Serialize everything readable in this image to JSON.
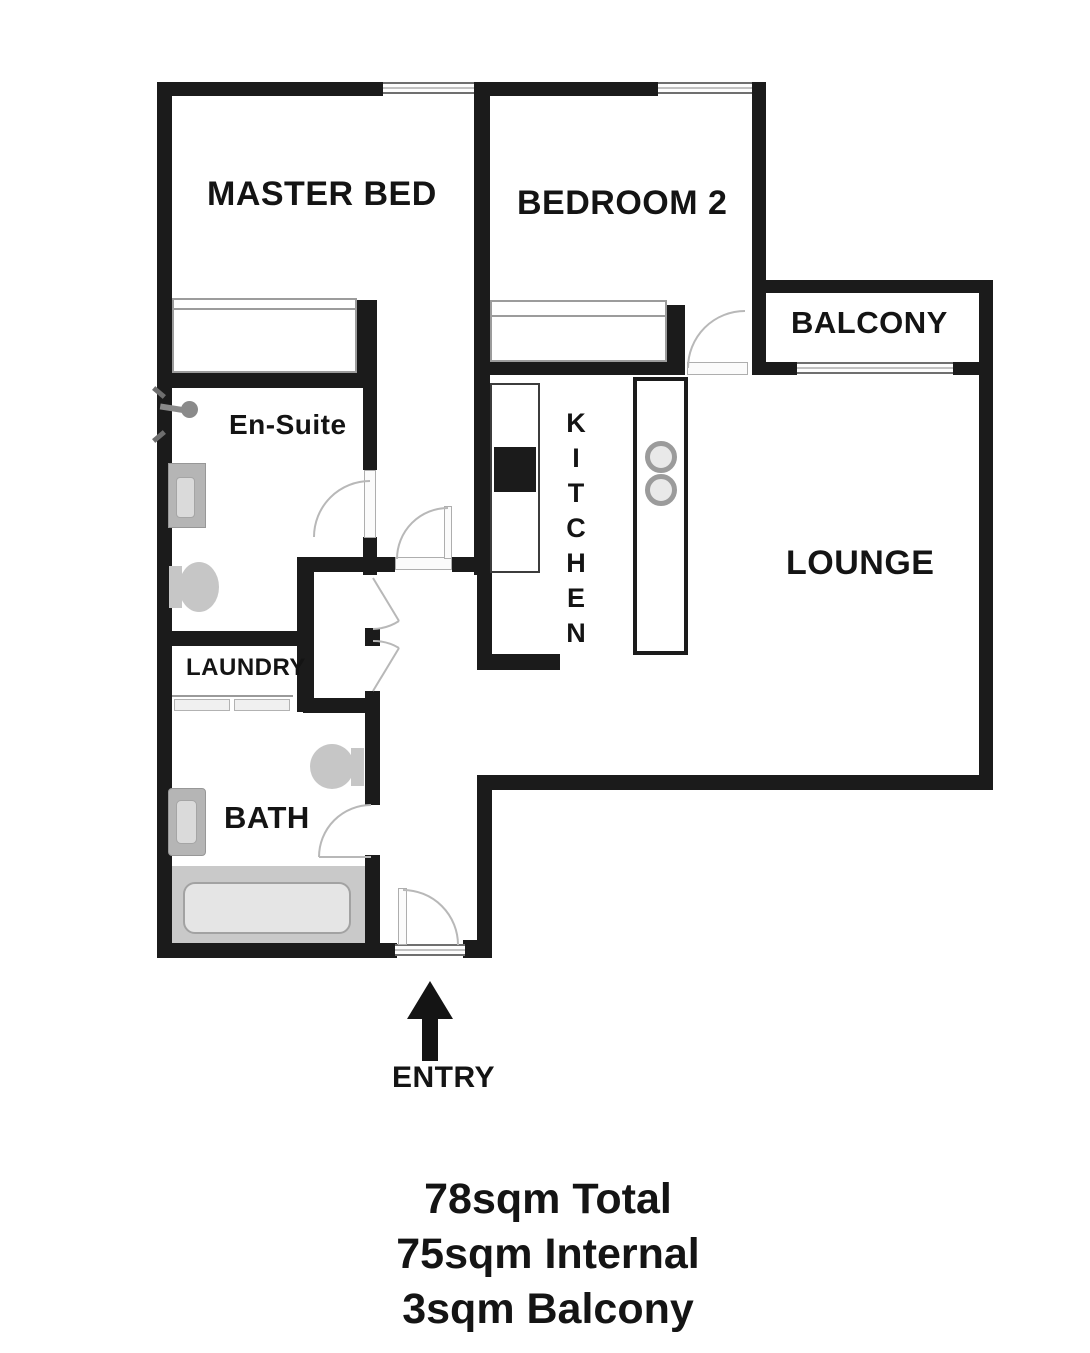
{
  "plan": {
    "rooms": {
      "master_bed": {
        "label": "MASTER BED"
      },
      "bedroom_2": {
        "label": "BEDROOM 2"
      },
      "balcony": {
        "label": "BALCONY"
      },
      "en_suite": {
        "label": "En-Suite"
      },
      "kitchen": {
        "label": "KITCHEN"
      },
      "lounge": {
        "label": "LOUNGE"
      },
      "laundry": {
        "label": "LAUNDRY"
      },
      "bath": {
        "label": "BATH"
      }
    },
    "entry": {
      "label": "ENTRY"
    },
    "fixtures": {
      "master_bed": [
        "built-in-robe"
      ],
      "bedroom_2": [
        "built-in-robe"
      ],
      "en_suite": [
        "shower",
        "vanity",
        "toilet"
      ],
      "kitchen": [
        "bench",
        "sink",
        "island",
        "cooktop-burners"
      ],
      "laundry": [
        "washer",
        "dryer"
      ],
      "bath": [
        "toilet",
        "vanity",
        "bathtub"
      ]
    },
    "windows": [
      "master-bed-window",
      "bedroom-2-window",
      "balcony-sliding-door",
      "entry-threshold"
    ]
  },
  "summary": {
    "total": "78sqm Total",
    "internal": "75sqm Internal",
    "balcony": "3sqm Balcony"
  },
  "colors": {
    "wall": "#1b1b1b",
    "background": "#ffffff",
    "fixture_gray": "#c4c4c4",
    "door_line": "#b8b8b8",
    "text": "#141414"
  }
}
